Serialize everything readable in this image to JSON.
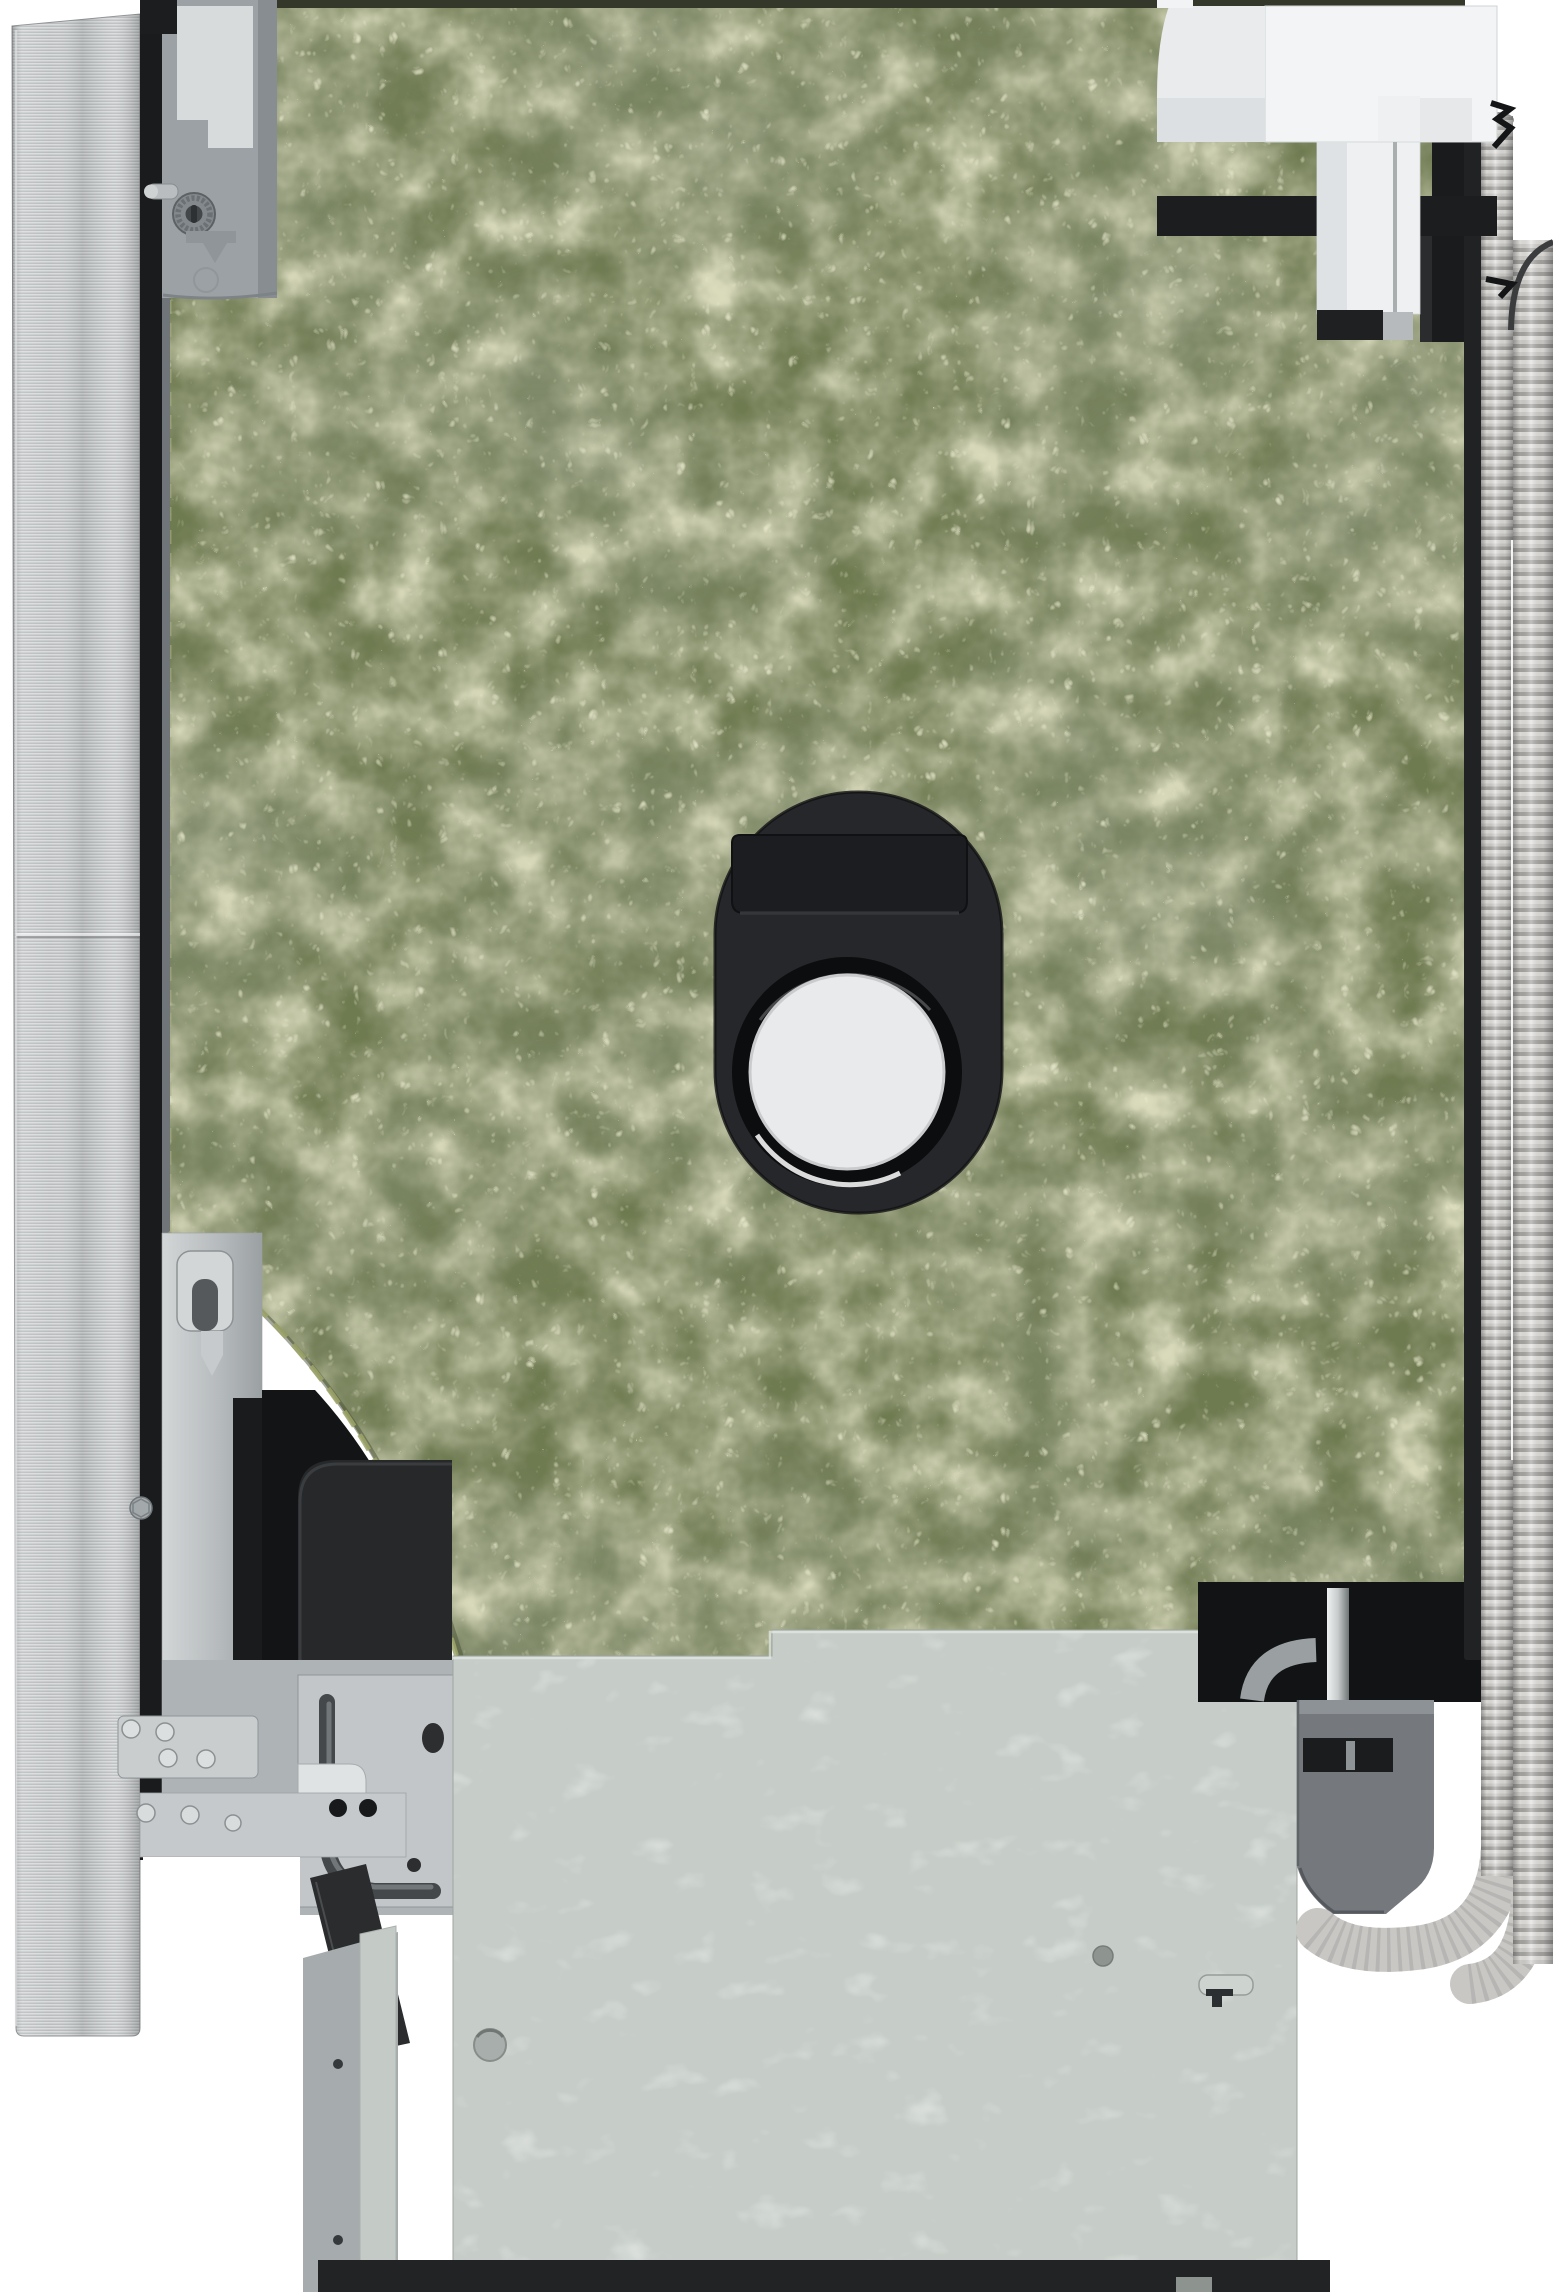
{
  "meta": {
    "type": "product-photo",
    "subject": "Built-in dishwasher, right side view",
    "description": "Cut-out studio photo of a built-in dishwasher seen from the side: brushed stainless door at left, green bitumen felt insulation mat covering the side panel, black oval service port with round inspection window in the center, door hinge mechanism at lower left, galvanized base plate at the bottom and corrugated drain hoses running down the right edge."
  },
  "parts": {
    "door_panel": "stainless-steel-door-panel",
    "door_edge": "door-edge-strip",
    "top_hinge": "upper-hinge-bracket",
    "leveling_wheel": "height-adjustment-wheel",
    "insulation": "bitumen-felt-insulation-mat",
    "port": "side-panel-service-port",
    "port_window": "port-inspection-window",
    "lower_hinge": "door-hinge-mechanism",
    "hinge_lever": "hinge-lever-with-curved-slot",
    "base_panel": "galvanized-base-plate",
    "foot": "rear-foot-panel",
    "bracket": "drain-hose-bracket",
    "hoses": "corrugated-drain-hoses",
    "valve": "water-inlet-assembly",
    "tub": "inner-tub-shadow"
  },
  "colors": {
    "background": "#ffffff",
    "white": "#ffffff",
    "stainless": "#c7cacc",
    "door_edge": "#191b1c",
    "hinge_gray": "#9ba1a4",
    "felt_base": "#6e7a50",
    "felt_dark": "#49523a",
    "felt_light": "#b9bd8f",
    "tub_black": "#131416",
    "black_zone": "#121315",
    "base_panel": "#c6cdc8",
    "foot_gray": "#a6abad",
    "bracket_gray": "#75797d",
    "hose_gray": "#c8c7c4",
    "white_plastic": "#f3f4f5",
    "bottom_strip": "#212324",
    "port_black": "#26272a",
    "port_window_white": "#e9eaeb"
  }
}
